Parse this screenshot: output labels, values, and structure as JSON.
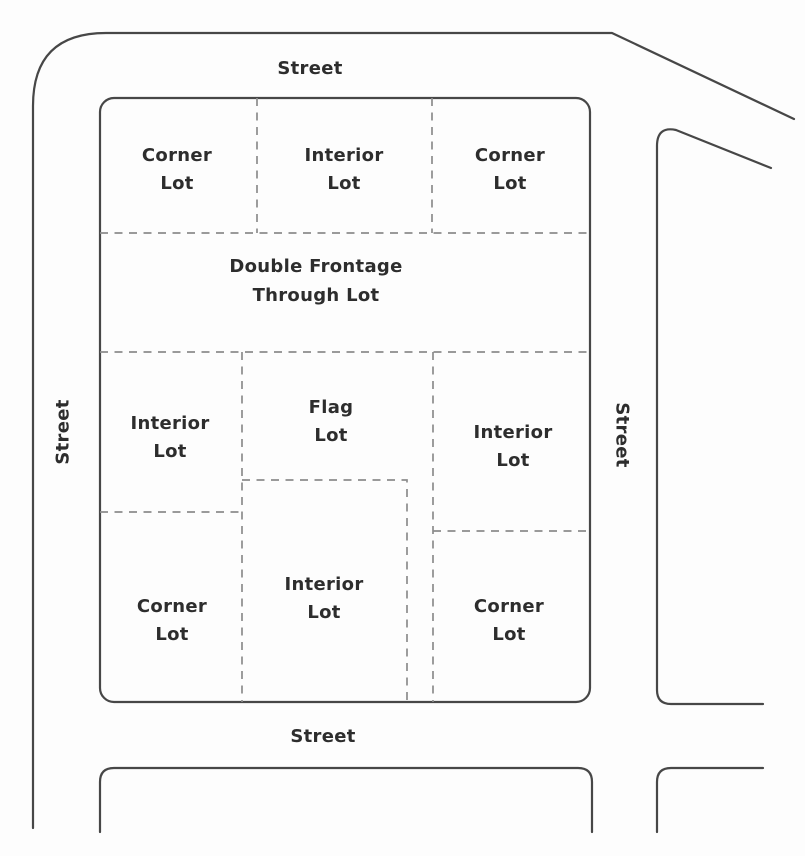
{
  "streets": [
    {
      "id": "top",
      "label": "Street"
    },
    {
      "id": "left",
      "label": "Street"
    },
    {
      "id": "right",
      "label": "Street"
    },
    {
      "id": "bottom",
      "label": "Street"
    }
  ],
  "lots": [
    {
      "id": "top-left",
      "type": "Corner Lot",
      "lines": [
        "Corner",
        "Lot"
      ]
    },
    {
      "id": "top-center",
      "type": "Interior Lot",
      "lines": [
        "Interior",
        "Lot"
      ]
    },
    {
      "id": "top-right",
      "type": "Corner Lot",
      "lines": [
        "Corner",
        "Lot"
      ]
    },
    {
      "id": "through",
      "type": "Double Frontage Through Lot",
      "lines": [
        "Double Frontage",
        "Through Lot"
      ]
    },
    {
      "id": "mid-left",
      "type": "Interior Lot",
      "lines": [
        "Interior",
        "Lot"
      ]
    },
    {
      "id": "flag",
      "type": "Flag Lot",
      "lines": [
        "Flag",
        "Lot"
      ]
    },
    {
      "id": "mid-right",
      "type": "Interior Lot",
      "lines": [
        "Interior",
        "Lot"
      ]
    },
    {
      "id": "bottom-left",
      "type": "Corner Lot",
      "lines": [
        "Corner",
        "Lot"
      ]
    },
    {
      "id": "bottom-center",
      "type": "Interior Lot",
      "lines": [
        "Interior",
        "Lot"
      ]
    },
    {
      "id": "bottom-right",
      "type": "Corner Lot",
      "lines": [
        "Corner",
        "Lot"
      ]
    }
  ],
  "colors": {
    "background": "#fdfdfd",
    "solid_line": "#474747",
    "dashed_line": "#8c8c8c",
    "text": "#2d2d2d"
  }
}
